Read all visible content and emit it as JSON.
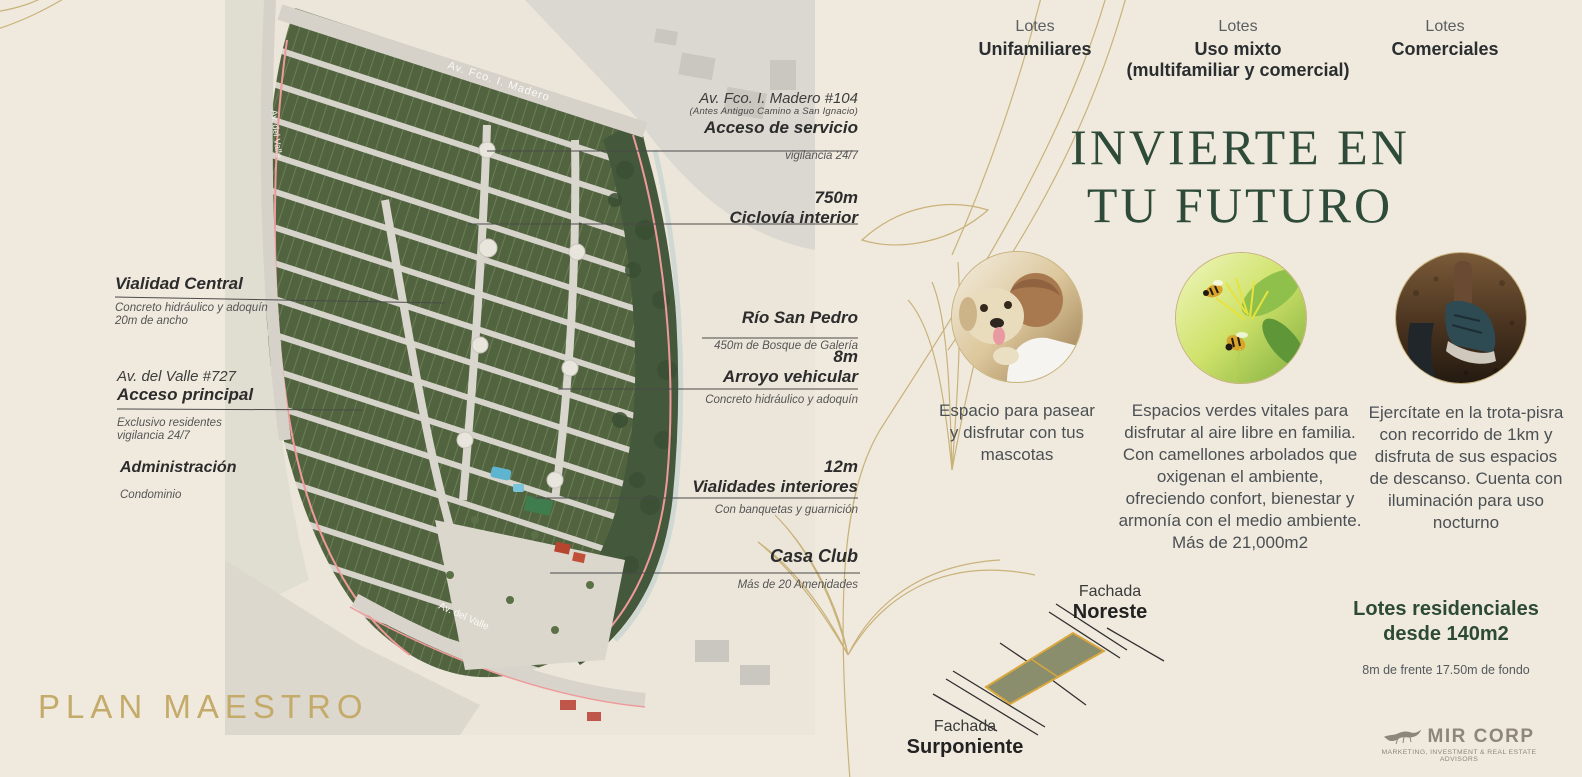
{
  "lot_types": [
    {
      "eyebrow": "Lotes",
      "name": "Unifamiliares",
      "sub": ""
    },
    {
      "eyebrow": "Lotes",
      "name": "Uso mixto",
      "sub": "(multifamiliar y comercial)"
    },
    {
      "eyebrow": "Lotes",
      "name": "Comerciales",
      "sub": ""
    }
  ],
  "hero": {
    "line1": "INVIERTE EN",
    "line2": "TU FUTURO"
  },
  "features": [
    {
      "photo": "dog-with-owner",
      "text": "Espacio para pasear y disfrutar con tus mascotas"
    },
    {
      "photo": "bees-on-flowers",
      "text": "Espacios verdes vitales para disfrutar al aire libre en familia. Con camellones arbolados que oxigenan el ambiente, ofreciendo confort, bienestar y armonía con el medio ambiente. Más de 21,000m2"
    },
    {
      "photo": "running-shoes",
      "text": "Ejercítate en la trota-pisra con recorrido de 1km y disfruta de sus espacios de descanso. Cuenta con iluminación para uso nocturno"
    }
  ],
  "annotations": {
    "acceso_servicio": {
      "pre": "Av. Fco. I. Madero #104",
      "pre_small": "(Antes Antiguo Camino a San Ignacio)",
      "title": "Acceso de servicio",
      "note": "vigilancia 24/7"
    },
    "ciclovia": {
      "title1": "750m",
      "title2": "Ciclovía interior"
    },
    "vialidad_central": {
      "title": "Vialidad Central",
      "note1": "Concreto hidráulico y adoquín",
      "note2": "20m de ancho"
    },
    "rio_san_pedro": {
      "title": "Río San Pedro",
      "note": "450m de Bosque de Galería"
    },
    "arroyo_vehicular": {
      "title1": "8m",
      "title2": "Arroyo vehicular",
      "note": "Concreto hidráulico y adoquín"
    },
    "acceso_principal": {
      "pre": "Av. del Valle #727",
      "title": "Acceso principal",
      "note1": "Exclusivo residentes",
      "note2": "vigilancia 24/7"
    },
    "administracion": {
      "title": "Administración",
      "note": "Condominio"
    },
    "vialidades_interiores": {
      "title1": "12m",
      "title2": "Vialidades interiores",
      "note": "Con banquetas y guarnición"
    },
    "casa_club": {
      "title": "Casa Club",
      "note": "Más de 20 Amenidades"
    }
  },
  "map": {
    "street_madero": "Av. Fco. I. Madero",
    "street_valle_left": "Av. del Valle",
    "street_valle_bottom": "Av. del Valle"
  },
  "plan_title": "PLAN MAESTRO",
  "fachada": {
    "ne1": "Fachada",
    "ne2": "Noreste",
    "sw1": "Fachada",
    "sw2": "Surponiente"
  },
  "residencial": {
    "line1": "Lotes residenciales",
    "line2": "desde 140m2",
    "sub": "8m de frente 17.50m de fondo"
  },
  "brand": {
    "name": "MIR CORP",
    "tagline": "MARKETING, INVESTMENT & REAL ESTATE ADVISORS"
  },
  "colors": {
    "accent_gold": "#c5ab6a",
    "brand_green": "#2e4a39",
    "lot_fill": "#8a8e6c",
    "lot_border": "#d9a73e"
  }
}
